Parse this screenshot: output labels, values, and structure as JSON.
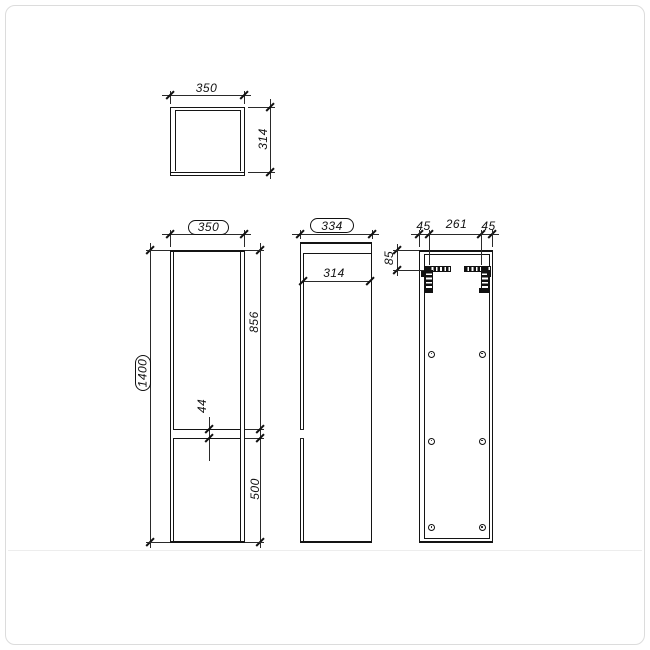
{
  "views": {
    "top": {
      "width": "350",
      "depth": "314"
    },
    "front": {
      "width": "350",
      "height": "1400",
      "upper_door": "856",
      "gap": "44",
      "lower_door": "500"
    },
    "side": {
      "depth": "334",
      "body_depth": "314"
    },
    "back": {
      "left_offset": "45",
      "bracket_span": "261",
      "right_offset": "45",
      "bracket_top_offset": "85"
    }
  },
  "colors": {
    "line": "#141414",
    "card_border": "#dcdcdc",
    "background": "#ffffff"
  }
}
